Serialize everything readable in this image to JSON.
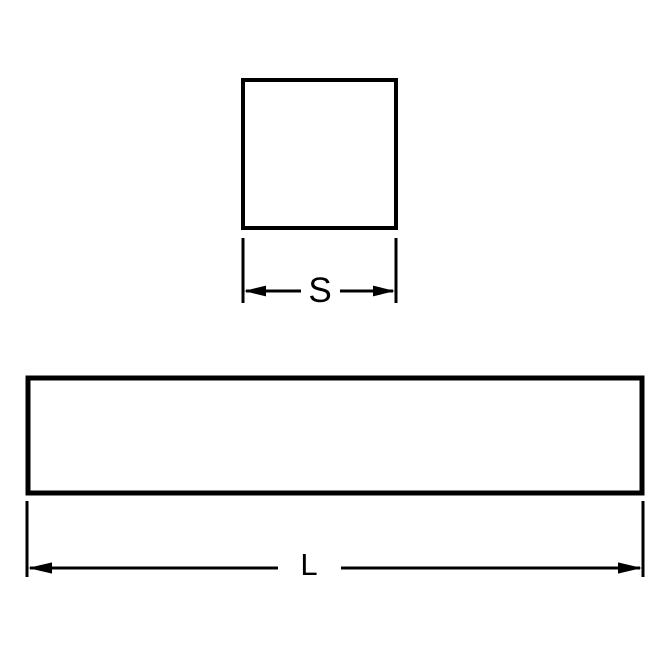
{
  "diagram": {
    "title": "square-bar-stock-dimension-drawing",
    "background_color": "#ffffff",
    "line_color": "#000000",
    "square_view": {
      "description": "square cross-section",
      "dimension_label": "S"
    },
    "bar_view": {
      "description": "bar length side view",
      "dimension_label": "L"
    }
  }
}
